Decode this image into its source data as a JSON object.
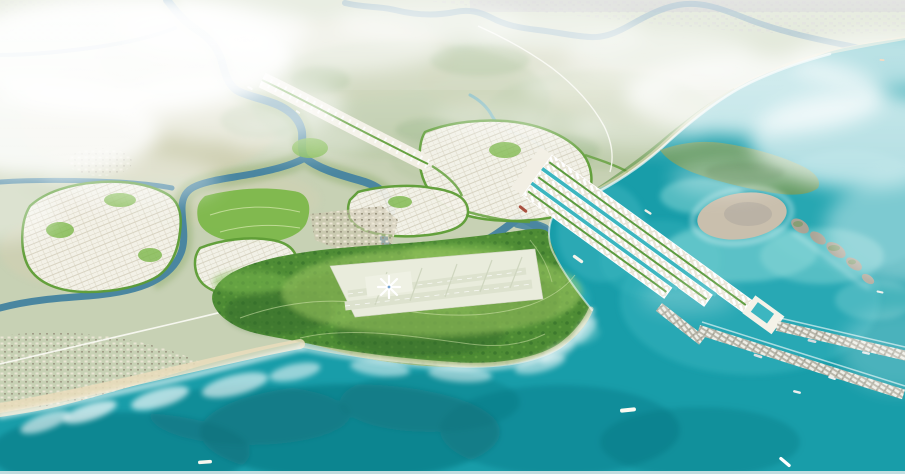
{
  "image": {
    "title": "Aerial bird's-eye rendering of a coastal master plan with winding rivers, planned districts, a star-shaped airport terminal, long seaport piers and offshore islands",
    "type": "3d-rendered-planning-visualization"
  },
  "palette": {
    "sea": "#189DA9",
    "seaDeep": "#0C6D78",
    "seaShallow": "#9ADFDD",
    "bay": "#3CB6C0",
    "land": "#C7D1B4",
    "landTan": "#D8CFB2",
    "landSage": "#AFC49C",
    "scrub": "#86A873",
    "distant": "#E2E8DB",
    "cityBand": "#BCBAC2",
    "river": "#4A86A0",
    "riverDistant": "#7AA3B8",
    "creek": "#6FB3C0",
    "forest": "#4E8C35",
    "forestDark": "#31682A",
    "forestLight": "#7CB94F",
    "limeRing": "#A9D168",
    "parcel": "#F5F3EA",
    "greenbelt": "#5E9D36",
    "parkGreen": "#7CB74A",
    "platform": "#E9ECDC",
    "runway": "#DDE2CE",
    "sand": "#EADDBC",
    "surf": "#FFFFFF",
    "town": "#D9D0BA",
    "portBand": "#F2EFE4",
    "portGreen": "#5D9C3F",
    "breakwater": "#B7B5A8",
    "island": "#C9BFAD",
    "isletRock": "#A9A496",
    "headland": "#6F9B5E",
    "road": "#FBFBF5",
    "haze": "#FFFFFF",
    "bottomEdge": "#D4E4E6",
    "terminalBlue": "#5A92C8"
  },
  "features": [
    {
      "name": "main-river",
      "desc": "dark winding river entering top-left, forking around planned districts to an estuary"
    },
    {
      "name": "distant-river",
      "desc": "meandering river along hazy horizon at top"
    },
    {
      "name": "forest-peninsula",
      "desc": "large green mangrove-forest headland on the south coast"
    },
    {
      "name": "airport",
      "desc": "airport platform with star-shaped terminal and parallel runways inside the forest"
    },
    {
      "name": "planned-districts",
      "desc": "white parcel grids with green belts on both sides of the river"
    },
    {
      "name": "linear-corridor",
      "desc": "development strip along a boulevard running to the river"
    },
    {
      "name": "central-park",
      "desc": "bright green park areas among districts"
    },
    {
      "name": "existing-towns",
      "desc": "beige built-up areas inland and along the southwest beach"
    },
    {
      "name": "beach-surf",
      "desc": "sandy beach with white surf along the southwest coast"
    },
    {
      "name": "port-strips",
      "desc": "three long reclaimed port strips with warehouse rows extending southeast into the sea"
    },
    {
      "name": "breakwater-piers",
      "desc": "two long container piers reaching the right edge, with moored vessels"
    },
    {
      "name": "tan-island",
      "desc": "flat bare island with surf ring off the northeast coast"
    },
    {
      "name": "islet-chain",
      "desc": "chain of small rocky islets trailing southeast"
    },
    {
      "name": "green-headland",
      "desc": "hilly green coastal headland at upper right"
    },
    {
      "name": "ships",
      "desc": "white cargo ships with wakes in the turquoise sea and river boats"
    },
    {
      "name": "haze-clouds",
      "desc": "white atmospheric haze over the top and left of the scene"
    },
    {
      "name": "expressway",
      "desc": "thin white curving road from inland toward the port"
    },
    {
      "name": "coastal-road",
      "desc": "white road running parallel to the southwest beach"
    }
  ],
  "sea_shading": {
    "deep": [
      [
        350,
        432,
        150,
        48,
        0.5
      ],
      [
        120,
        452,
        130,
        40,
        0.45
      ],
      [
        560,
        430,
        120,
        45,
        0.32
      ],
      [
        430,
        402,
        90,
        30,
        0.3
      ],
      [
        700,
        442,
        100,
        35,
        0.28
      ],
      [
        250,
        415,
        100,
        30,
        0.35
      ]
    ],
    "bright": [
      [
        750,
        300,
        130,
        75,
        0.45
      ],
      [
        850,
        210,
        90,
        60,
        0.4
      ],
      [
        602,
        232,
        45,
        50,
        0.5
      ],
      [
        558,
        300,
        32,
        26,
        0.45
      ],
      [
        660,
        260,
        60,
        40,
        0.35
      ]
    ],
    "shallow": [
      [
        740,
        252,
        78,
        30,
        0.45
      ],
      [
        822,
        256,
        62,
        28,
        0.4
      ],
      [
        702,
        196,
        42,
        18,
        0.45
      ],
      [
        560,
        332,
        40,
        16,
        0.3
      ],
      [
        875,
        300,
        40,
        20,
        0.3
      ]
    ]
  },
  "land_texture": {
    "tan": [
      [
        150,
        120,
        130,
        60,
        0.5
      ],
      [
        90,
        250,
        90,
        40,
        0.4
      ],
      [
        340,
        60,
        120,
        40,
        0.35
      ],
      [
        240,
        200,
        80,
        30,
        0.3
      ],
      [
        520,
        80,
        100,
        35,
        0.3
      ],
      [
        640,
        95,
        90,
        30,
        0.3
      ]
    ],
    "sage": [
      [
        400,
        100,
        150,
        60,
        0.4
      ],
      [
        600,
        120,
        120,
        50,
        0.4
      ],
      [
        200,
        60,
        100,
        40,
        0.35
      ],
      [
        480,
        160,
        90,
        30,
        0.3
      ]
    ],
    "scrub": [
      [
        260,
        120,
        40,
        18,
        0.35
      ],
      [
        320,
        80,
        30,
        14,
        0.3
      ],
      [
        480,
        60,
        50,
        16,
        0.3
      ],
      [
        560,
        150,
        40,
        16,
        0.3
      ],
      [
        140,
        200,
        30,
        12,
        0.3
      ],
      [
        430,
        130,
        35,
        12,
        0.3
      ]
    ]
  },
  "foam": [
    [
      90,
      412,
      28,
      8,
      -18,
      0.7
    ],
    [
      160,
      398,
      30,
      9,
      -16,
      0.65
    ],
    [
      235,
      385,
      34,
      10,
      -14,
      0.6
    ],
    [
      295,
      372,
      26,
      8,
      -12,
      0.55
    ],
    [
      380,
      368,
      30,
      8,
      6,
      0.5
    ],
    [
      460,
      374,
      32,
      8,
      4,
      0.5
    ],
    [
      540,
      364,
      26,
      8,
      -14,
      0.5
    ],
    [
      585,
      330,
      16,
      7,
      -50,
      0.5
    ],
    [
      558,
      352,
      20,
      7,
      -30,
      0.45
    ],
    [
      45,
      422,
      26,
      8,
      -20,
      0.6
    ]
  ],
  "haze": [
    [
      120,
      55,
      175,
      60,
      0.92
    ],
    [
      40,
      130,
      120,
      48,
      0.85
    ],
    [
      215,
      30,
      95,
      28,
      0.6
    ],
    [
      230,
      105,
      115,
      36,
      0.55
    ],
    [
      330,
      45,
      115,
      28,
      0.5
    ],
    [
      430,
      22,
      95,
      20,
      0.45
    ],
    [
      560,
      33,
      85,
      20,
      0.4
    ],
    [
      660,
      55,
      95,
      25,
      0.45
    ],
    [
      755,
      95,
      130,
      40,
      0.72
    ],
    [
      860,
      140,
      110,
      48,
      0.68
    ],
    [
      880,
      60,
      90,
      28,
      0.55
    ],
    [
      905,
      230,
      80,
      55,
      0.4
    ],
    [
      640,
      128,
      68,
      20,
      0.35
    ],
    [
      598,
      88,
      75,
      22,
      0.38
    ],
    [
      130,
      180,
      90,
      26,
      0.38
    ],
    [
      300,
      140,
      70,
      18,
      0.3
    ],
    [
      490,
      118,
      58,
      16,
      0.28
    ],
    [
      0,
      210,
      60,
      32,
      0.38
    ],
    [
      725,
      178,
      55,
      18,
      0.3
    ],
    [
      900,
      350,
      60,
      42,
      0.22
    ],
    [
      688,
      298,
      48,
      16,
      0.22
    ],
    [
      560,
      125,
      48,
      14,
      0.25
    ]
  ],
  "ships": [
    {
      "x": 250,
      "y": 88,
      "rot": 28,
      "len": 6,
      "w": 2,
      "color": "#F2F2EC",
      "wake": false,
      "type": "river-boat"
    },
    {
      "x": 298,
      "y": 112,
      "rot": 35,
      "len": 5,
      "w": 1.8,
      "color": "#E9E9E2",
      "wake": false,
      "type": "river-boat"
    },
    {
      "x": 523,
      "y": 209,
      "rot": 38,
      "len": 10,
      "w": 3,
      "color": "#A8503E",
      "wake": false,
      "type": "cargo-ship"
    },
    {
      "x": 578,
      "y": 259,
      "rot": 36,
      "len": 12,
      "w": 3.2,
      "color": "#F4F4EC",
      "wake": false,
      "type": "cargo-ship"
    },
    {
      "x": 648,
      "y": 212,
      "rot": 32,
      "len": 8,
      "w": 2.4,
      "color": "#EFEFE8",
      "wake": false,
      "type": "cargo-ship"
    },
    {
      "x": 628,
      "y": 410,
      "rot": -6,
      "len": 16,
      "w": 4,
      "color": "#FAFAF2",
      "wake": true,
      "type": "cargo-ship"
    },
    {
      "x": 205,
      "y": 462,
      "rot": -4,
      "len": 14,
      "w": 3.6,
      "color": "#F6F6EE",
      "wake": true,
      "type": "cargo-ship"
    },
    {
      "x": 785,
      "y": 462,
      "rot": 40,
      "len": 14,
      "w": 3.2,
      "color": "#FFFFFF",
      "wake": true,
      "type": "cargo-ship"
    },
    {
      "x": 797,
      "y": 392,
      "rot": 14,
      "len": 8,
      "w": 2.4,
      "color": "#ECEEEE",
      "wake": false,
      "type": "cargo-ship"
    },
    {
      "x": 880,
      "y": 292,
      "rot": 12,
      "len": 7,
      "w": 2,
      "color": "#F0F2EE",
      "wake": false,
      "type": "cargo-ship"
    },
    {
      "x": 882,
      "y": 60,
      "rot": 5,
      "len": 5,
      "w": 1.8,
      "color": "#D98A3F",
      "wake": false,
      "type": "distant-ship"
    },
    {
      "x": 812,
      "y": 341,
      "rot": 13,
      "len": 9,
      "w": 2.6,
      "color": "#D8DCE0",
      "wake": false,
      "type": "moored-vessel"
    },
    {
      "x": 866,
      "y": 353,
      "rot": 13,
      "len": 8,
      "w": 2.4,
      "color": "#E4E8EA",
      "wake": false,
      "type": "moored-vessel"
    },
    {
      "x": 758,
      "y": 356,
      "rot": 18,
      "len": 9,
      "w": 2.6,
      "color": "#DDE0E2",
      "wake": false,
      "type": "moored-vessel"
    },
    {
      "x": 832,
      "y": 378,
      "rot": 18,
      "len": 8,
      "w": 2.2,
      "color": "#ECEEEE",
      "wake": false,
      "type": "moored-vessel"
    }
  ]
}
